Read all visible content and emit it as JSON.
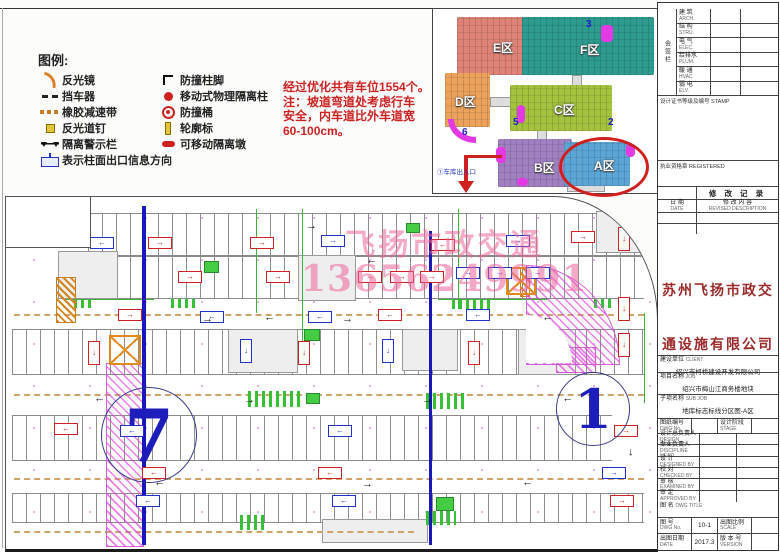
{
  "legend": {
    "title": "图例:",
    "left": [
      {
        "icon": "mirror",
        "label": "反光镜"
      },
      {
        "icon": "stopper",
        "label": "挡车器"
      },
      {
        "icon": "speedbump",
        "label": "橡胶减速带"
      },
      {
        "icon": "roadstud",
        "label": "反光道钉"
      },
      {
        "icon": "warnrail",
        "label": "隔离警示栏"
      }
    ],
    "right": [
      {
        "icon": "columnfoot",
        "label": "防撞柱脚"
      },
      {
        "icon": "isopillar",
        "label": "移动式物理隔离柱"
      },
      {
        "icon": "bucket",
        "label": "防撞桶"
      },
      {
        "icon": "contour",
        "label": "轮廓标"
      },
      {
        "icon": "isopier",
        "label": "可移动隔离墩"
      }
    ],
    "bottom": {
      "icon": "exitsign",
      "label": "表示柱面出口信息方向"
    }
  },
  "note": {
    "lines": [
      "经过优化共有车位1554个。",
      "注：坡道弯道处考虑行车",
      "安全，内车道比外车道宽",
      "60-100cm。"
    ]
  },
  "keymap": {
    "zones": [
      {
        "name": "E",
        "label": "E区",
        "x": 24,
        "y": 8,
        "w": 78,
        "h": 58,
        "color": "#df8377",
        "lx": 36,
        "ly": 22
      },
      {
        "name": "F",
        "label": "F区",
        "x": 89,
        "y": 8,
        "w": 132,
        "h": 58,
        "color": "#2d9b8f",
        "lx": 58,
        "ly": 24
      },
      {
        "name": "D",
        "label": "D区",
        "x": 12,
        "y": 64,
        "w": 45,
        "h": 54,
        "color": "#eca25b",
        "lx": 10,
        "ly": 20
      },
      {
        "name": "C",
        "label": "C区",
        "x": 77,
        "y": 76,
        "w": 102,
        "h": 46,
        "color": "#a3c23e",
        "lx": 44,
        "ly": 16
      },
      {
        "name": "B",
        "label": "B区",
        "x": 65,
        "y": 130,
        "w": 74,
        "h": 48,
        "color": "#a180c2",
        "lx": 36,
        "ly": 20
      },
      {
        "name": "A",
        "label": "A区",
        "x": 131,
        "y": 133,
        "w": 66,
        "h": 44,
        "color": "#5ba6d6",
        "lx": 30,
        "ly": 15
      }
    ],
    "connectors": [
      {
        "x": 57,
        "y": 88,
        "w": 22,
        "h": 8
      },
      {
        "x": 139,
        "y": 66,
        "w": 8,
        "h": 12
      },
      {
        "x": 104,
        "y": 120,
        "w": 8,
        "h": 12
      },
      {
        "x": 134,
        "y": 175,
        "w": 36,
        "h": 6
      }
    ],
    "numbers": [
      {
        "t": "3",
        "x": 153,
        "y": 10
      },
      {
        "t": "5",
        "x": 80,
        "y": 108
      },
      {
        "t": "2",
        "x": 175,
        "y": 108
      },
      {
        "t": "6",
        "x": 29,
        "y": 118
      }
    ],
    "blobs": [
      {
        "x": 168,
        "y": 16,
        "w": 12,
        "h": 17
      },
      {
        "x": 84,
        "y": 96,
        "w": 8,
        "h": 18
      },
      {
        "x": 63,
        "y": 138,
        "w": 10,
        "h": 16
      },
      {
        "x": 193,
        "y": 135,
        "w": 9,
        "h": 13
      },
      {
        "x": 84,
        "y": 169,
        "w": 11,
        "h": 8
      }
    ],
    "arc_blob": {
      "x": 15,
      "y": 110,
      "w": 22,
      "h": 18
    },
    "entrance_label": "①车库出入口"
  },
  "plan": {
    "watermark_line1": "飞扬市政交通",
    "watermark_line2": "13656249991",
    "circle7": "7",
    "circle1": "1",
    "bands": [
      {
        "x": 82,
        "y": 16,
        "w": 556,
        "h": 42
      },
      {
        "x": 82,
        "y": 58,
        "w": 556,
        "h": 42
      },
      {
        "x": 6,
        "y": 132,
        "w": 632,
        "h": 44
      },
      {
        "x": 6,
        "y": 218,
        "w": 600,
        "h": 44
      },
      {
        "x": 6,
        "y": 296,
        "w": 632,
        "h": 28
      }
    ],
    "dashes": [
      {
        "x": 8,
        "y": 117,
        "w": 630
      },
      {
        "x": 8,
        "y": 197,
        "w": 630
      },
      {
        "x": 8,
        "y": 281,
        "w": 630
      },
      {
        "x": 8,
        "y": 334,
        "w": 400
      }
    ],
    "cores": [
      {
        "x": 52,
        "y": 54,
        "w": 58,
        "h": 46
      },
      {
        "x": 222,
        "y": 132,
        "w": 68,
        "h": 42
      },
      {
        "x": 512,
        "y": 132,
        "w": 56,
        "h": 44
      },
      {
        "x": 590,
        "y": 14,
        "w": 44,
        "h": 40
      },
      {
        "x": 292,
        "y": 58,
        "w": 56,
        "h": 44
      },
      {
        "x": 396,
        "y": 132,
        "w": 54,
        "h": 40
      },
      {
        "x": 316,
        "y": 322,
        "w": 104,
        "h": 22
      }
    ],
    "green_stripes": [
      {
        "x": 242,
        "y": 194,
        "w": 52,
        "h": 16
      },
      {
        "x": 420,
        "y": 196,
        "w": 42,
        "h": 16
      },
      {
        "x": 446,
        "y": 102,
        "w": 40,
        "h": 10
      },
      {
        "x": 165,
        "y": 102,
        "w": 28,
        "h": 9
      },
      {
        "x": 68,
        "y": 102,
        "w": 18,
        "h": 9
      },
      {
        "x": 234,
        "y": 318,
        "w": 26,
        "h": 15
      },
      {
        "x": 420,
        "y": 314,
        "w": 30,
        "h": 14
      },
      {
        "x": 588,
        "y": 102,
        "w": 18,
        "h": 9
      }
    ],
    "green_solids": [
      {
        "x": 198,
        "y": 64,
        "w": 13,
        "h": 10
      },
      {
        "x": 400,
        "y": 26,
        "w": 12,
        "h": 8
      },
      {
        "x": 298,
        "y": 132,
        "w": 14,
        "h": 10
      },
      {
        "x": 634,
        "y": 12,
        "w": 10,
        "h": 8
      },
      {
        "x": 300,
        "y": 196,
        "w": 12,
        "h": 9
      },
      {
        "x": 430,
        "y": 300,
        "w": 16,
        "h": 12
      }
    ],
    "green_lines": [
      {
        "x": 250,
        "y": 12,
        "w": 1,
        "h": 104
      },
      {
        "x": 296,
        "y": 12,
        "w": 1,
        "h": 134
      },
      {
        "x": 452,
        "y": 12,
        "w": 1,
        "h": 100
      },
      {
        "x": 638,
        "y": 116,
        "w": 1,
        "h": 90
      },
      {
        "x": 58,
        "y": 102,
        "w": 90,
        "h": 1
      },
      {
        "x": 432,
        "y": 102,
        "w": 110,
        "h": 1
      }
    ],
    "bumps": [
      {
        "x": 50,
        "y": 80,
        "w": 18,
        "h": 44
      },
      {
        "x": 514,
        "y": 70,
        "w": 8,
        "h": 28
      }
    ],
    "ramps": [
      {
        "x": 100,
        "y": 166,
        "w": 36,
        "h": 182,
        "round": ""
      },
      {
        "x": 520,
        "y": 68,
        "w": 92,
        "h": 98,
        "round": "0 100% 0 0"
      },
      {
        "x": 550,
        "y": 150,
        "w": 38,
        "h": 24,
        "round": ""
      }
    ],
    "xboxes": [
      {
        "x": 103,
        "y": 138,
        "w": 32,
        "h": 30
      },
      {
        "x": 500,
        "y": 70,
        "w": 30,
        "h": 28
      }
    ],
    "bluelines": [
      {
        "x": 136,
        "y": 9,
        "w": 3.5,
        "h": 339
      },
      {
        "x": 423,
        "y": 34,
        "w": 3,
        "h": 314
      }
    ],
    "signs": [
      {
        "c": "b",
        "d": "l",
        "x": 84,
        "y": 40
      },
      {
        "c": "r",
        "d": "r",
        "x": 142,
        "y": 40
      },
      {
        "c": "r",
        "d": "r",
        "x": 244,
        "y": 40
      },
      {
        "c": "b",
        "d": "r",
        "x": 315,
        "y": 38
      },
      {
        "c": "r",
        "d": "l",
        "x": 425,
        "y": 42
      },
      {
        "c": "b",
        "d": "r",
        "x": 500,
        "y": 38
      },
      {
        "c": "r",
        "d": "r",
        "x": 565,
        "y": 34
      },
      {
        "c": "r",
        "d": "r",
        "x": 172,
        "y": 74
      },
      {
        "c": "r",
        "d": "r",
        "x": 260,
        "y": 74
      },
      {
        "c": "r",
        "d": "r",
        "x": 352,
        "y": 74
      },
      {
        "c": "r",
        "d": "r",
        "x": 384,
        "y": 74
      },
      {
        "c": "r",
        "d": "r",
        "x": 414,
        "y": 74
      },
      {
        "c": "b",
        "d": "r",
        "x": 450,
        "y": 70
      },
      {
        "c": "b",
        "d": "r",
        "x": 482,
        "y": 70
      },
      {
        "c": "b",
        "d": "r",
        "x": 520,
        "y": 70
      },
      {
        "c": "r",
        "d": "r",
        "x": 112,
        "y": 112
      },
      {
        "c": "b",
        "d": "l",
        "x": 194,
        "y": 114
      },
      {
        "c": "b",
        "d": "l",
        "x": 302,
        "y": 114
      },
      {
        "c": "r",
        "d": "l",
        "x": 372,
        "y": 112
      },
      {
        "c": "b",
        "d": "l",
        "x": 460,
        "y": 112
      },
      {
        "c": "r",
        "d": "d",
        "x": 82,
        "y": 144,
        "v": 1
      },
      {
        "c": "b",
        "d": "d",
        "x": 234,
        "y": 142,
        "v": 1
      },
      {
        "c": "r",
        "d": "d",
        "x": 292,
        "y": 144,
        "v": 1
      },
      {
        "c": "b",
        "d": "d",
        "x": 376,
        "y": 142,
        "v": 1
      },
      {
        "c": "r",
        "d": "d",
        "x": 462,
        "y": 144,
        "v": 1
      },
      {
        "c": "r",
        "d": "l",
        "x": 48,
        "y": 226
      },
      {
        "c": "b",
        "d": "l",
        "x": 114,
        "y": 228
      },
      {
        "c": "b",
        "d": "l",
        "x": 322,
        "y": 228
      },
      {
        "c": "r",
        "d": "r",
        "x": 608,
        "y": 228
      },
      {
        "c": "r",
        "d": "l",
        "x": 136,
        "y": 270
      },
      {
        "c": "r",
        "d": "l",
        "x": 312,
        "y": 270
      },
      {
        "c": "b",
        "d": "r",
        "x": 596,
        "y": 270
      },
      {
        "c": "b",
        "d": "l",
        "x": 130,
        "y": 298
      },
      {
        "c": "b",
        "d": "l",
        "x": 326,
        "y": 298
      },
      {
        "c": "r",
        "d": "r",
        "x": 604,
        "y": 298
      },
      {
        "c": "r",
        "d": "d",
        "x": 612,
        "y": 30,
        "v": 1
      },
      {
        "c": "r",
        "d": "d",
        "x": 612,
        "y": 100,
        "v": 1
      },
      {
        "c": "r",
        "d": "d",
        "x": 612,
        "y": 136,
        "v": 1
      }
    ],
    "arrows": [
      {
        "x": 196,
        "y": 117,
        "r": 0
      },
      {
        "x": 258,
        "y": 117,
        "r": 180
      },
      {
        "x": 336,
        "y": 117,
        "r": 0
      },
      {
        "x": 536,
        "y": 117,
        "r": 180
      },
      {
        "x": 88,
        "y": 198,
        "r": 180
      },
      {
        "x": 238,
        "y": 198,
        "r": 0
      },
      {
        "x": 416,
        "y": 198,
        "r": 0
      },
      {
        "x": 556,
        "y": 198,
        "r": 180
      },
      {
        "x": 148,
        "y": 282,
        "r": 180
      },
      {
        "x": 356,
        "y": 282,
        "r": 0
      },
      {
        "x": 516,
        "y": 282,
        "r": 180
      },
      {
        "x": 300,
        "y": 24,
        "r": 0
      },
      {
        "x": 360,
        "y": 60,
        "r": 180
      },
      {
        "x": 620,
        "y": 250,
        "r": 90
      }
    ]
  },
  "titleblock": {
    "consign_side": "会签栏",
    "consign_rows": [
      {
        "cn": "建 筑",
        "en": "ARCH."
      },
      {
        "cn": "结 构",
        "en": "STRU."
      },
      {
        "cn": "电 气",
        "en": "ELEC."
      },
      {
        "cn": "给排水",
        "en": "PLUM."
      },
      {
        "cn": "暖 通",
        "en": "HVAC"
      },
      {
        "cn": "弱 电",
        "en": "ELV."
      }
    ],
    "stamp_label": "设计证书等级及编号 STAMP",
    "registered_label": "执业资格章 REGISTERED",
    "revision_title": "修 改 记 录",
    "rev_col1": "日 期",
    "rev_col1_en": "DATE",
    "rev_col2": "修 改 内 容",
    "rev_col2_en": "REVISED DESCRIPTION",
    "company_line1": "苏州飞扬市政交",
    "company_line2": "通设施有限公司",
    "client_label": "建设单位",
    "client_en": "CLIENT",
    "client_value": "绍兴市柯桥建设开发有限公司",
    "job_label": "项目名称",
    "job_en": "JOB",
    "job_value": "绍兴市梅山江商务楼地块",
    "subjob_label": "子项名称",
    "sub_en": "SUB JOB",
    "subjob_value": "地库标志标线分区图-A区",
    "dwgno_label": "图纸编号",
    "dwgno_en": "DWG No.",
    "dwgno_value": "",
    "stage_label": "设计阶段",
    "stage_en": "STAGE",
    "stage_value": "",
    "person_rows": [
      {
        "cn": "设计总负责人",
        "en": "DESIGN DIRECTOR"
      },
      {
        "cn": "专业负责人",
        "en": "DISCIPLINE HEAD"
      },
      {
        "cn": "设 计",
        "en": "DESIGNED BY"
      },
      {
        "cn": "校 对",
        "en": "CHECKED BY"
      },
      {
        "cn": "审 核",
        "en": "EXAMINED BY"
      },
      {
        "cn": "审 定",
        "en": "APPROVED BY"
      }
    ],
    "dwgtitle_label": "图 名",
    "dwgtitle_en": "DWG TITLE",
    "b1": [
      {
        "cn": "图 号",
        "en": "DWG No."
      },
      {
        "val": "10-1"
      },
      {
        "cn": "出图比例",
        "en": "SCALE"
      },
      {
        "val": ""
      }
    ],
    "b2": [
      {
        "cn": "出图日期",
        "en": "DATE"
      },
      {
        "val": "2017.3"
      },
      {
        "cn": "版 本 号",
        "en": "VERSION"
      },
      {
        "val": ""
      }
    ]
  }
}
